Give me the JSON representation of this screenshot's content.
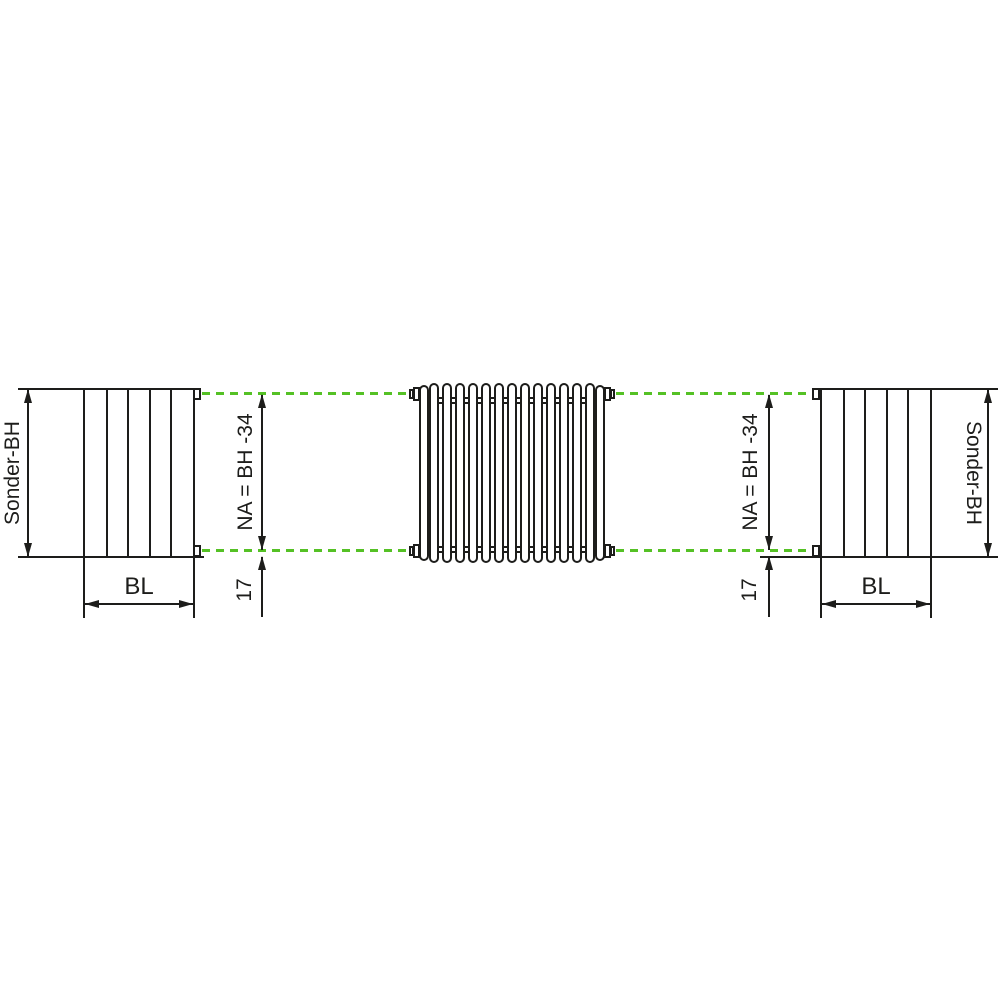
{
  "colors": {
    "line_color": "#1d1d1b",
    "axis_green": "#55c125",
    "background": "#ffffff"
  },
  "labels": {
    "sonder_bh_left": "Sonder-BH",
    "sonder_bh_right": "Sonder-BH",
    "bl_left": "BL",
    "bl_right": "BL",
    "na_left": "NA = BH -34",
    "na_right": "NA = BH -34",
    "offset_left": "17",
    "offset_right": "17"
  }
}
